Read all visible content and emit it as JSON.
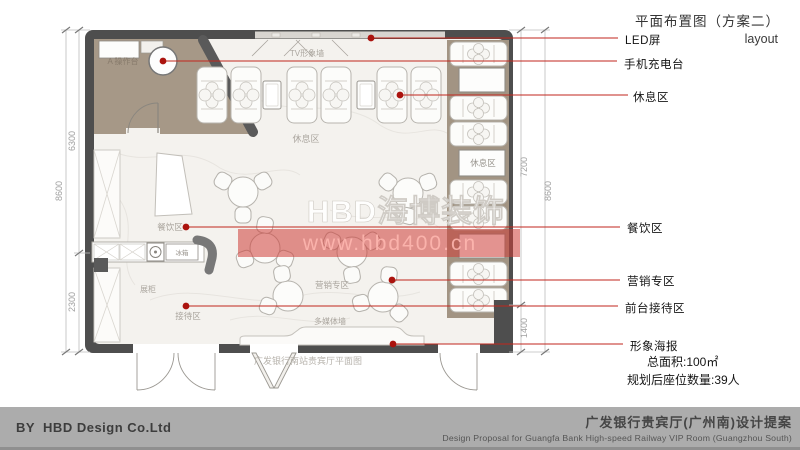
{
  "header": {
    "title_cn": "平面布置图（方案二）",
    "title_en": "layout"
  },
  "callouts": [
    {
      "label": "LED屏"
    },
    {
      "label": "手机充电台"
    },
    {
      "label": "休息区"
    },
    {
      "label": "餐饮区"
    },
    {
      "label": "营销专区"
    },
    {
      "label": "前台接待区"
    },
    {
      "label": "形象海报"
    }
  ],
  "stats": {
    "area": "总面积:100㎡",
    "seats": "规划后座位数量:39人"
  },
  "plan": {
    "room_labels": {
      "operation": "A 操作台",
      "tv_wall": "TV形象墙",
      "rest_area_top": "休息区",
      "rest_area_right": "休息区",
      "dining": "餐饮区",
      "marketing": "营销专区",
      "reception": "接待区",
      "display_cabinet": "展柜",
      "fridge": "冰箱",
      "media_wall": "多媒体墙"
    },
    "caption": "广发银行南站贵宾厅平面图",
    "dimensions": {
      "left_total": "8600",
      "left_upper": "6300",
      "left_lower": "2300",
      "right_total": "8600",
      "right_upper": "7200",
      "right_lower": "1400"
    }
  },
  "watermark": {
    "brand": "HBD海博装饰",
    "url": "www.hbd400.cn"
  },
  "footer": {
    "company": "BY  HBD Design Co.Ltd",
    "project_cn": "广发银行贵宾厅(广州南)设计提案",
    "project_en": "Design Proposal for Guangfa Bank High-speed Railway VIP Room (Guangzhou South)"
  },
  "colors": {
    "wall": "#4e4e4e",
    "leader_red": "#c1261c",
    "room_tan": "#a69887",
    "column_wood": "#a29483",
    "footer_gray": "#acacac",
    "watermark_band": "#cd3c37"
  }
}
